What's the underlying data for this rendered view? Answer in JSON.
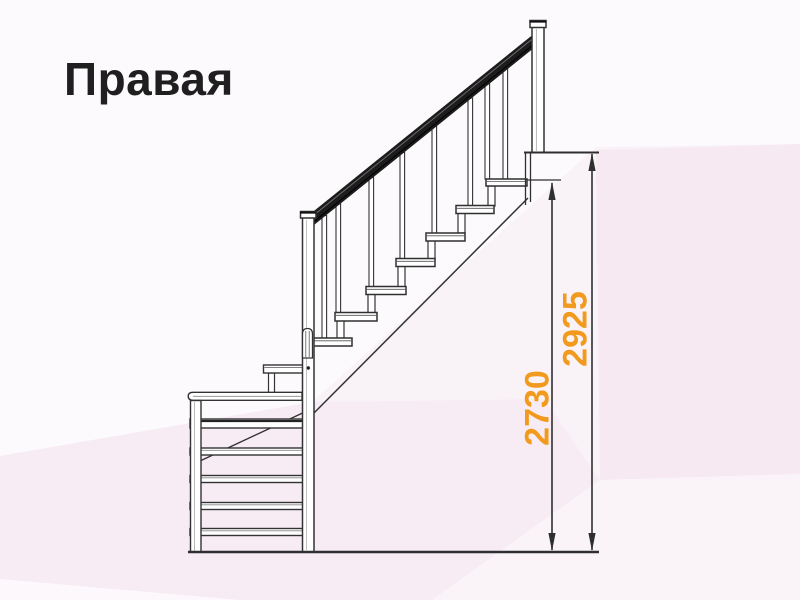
{
  "page": {
    "title": "Правая"
  },
  "diagram": {
    "type": "staircase-side-elevation",
    "description_elements": [
      "quarter-turn staircase",
      "handrail",
      "balusters",
      "open treads",
      "lower flight front view",
      "floor line",
      "upper landing"
    ],
    "dimensions": [
      {
        "name": "height-to-top-step",
        "value": "2730"
      },
      {
        "name": "total-height",
        "value": "2925"
      }
    ],
    "colors": {
      "dimension_text": "#f29a1e",
      "line": "#333333",
      "handrail": "#1c1c1c",
      "background_base": "#f9f3f8"
    }
  }
}
